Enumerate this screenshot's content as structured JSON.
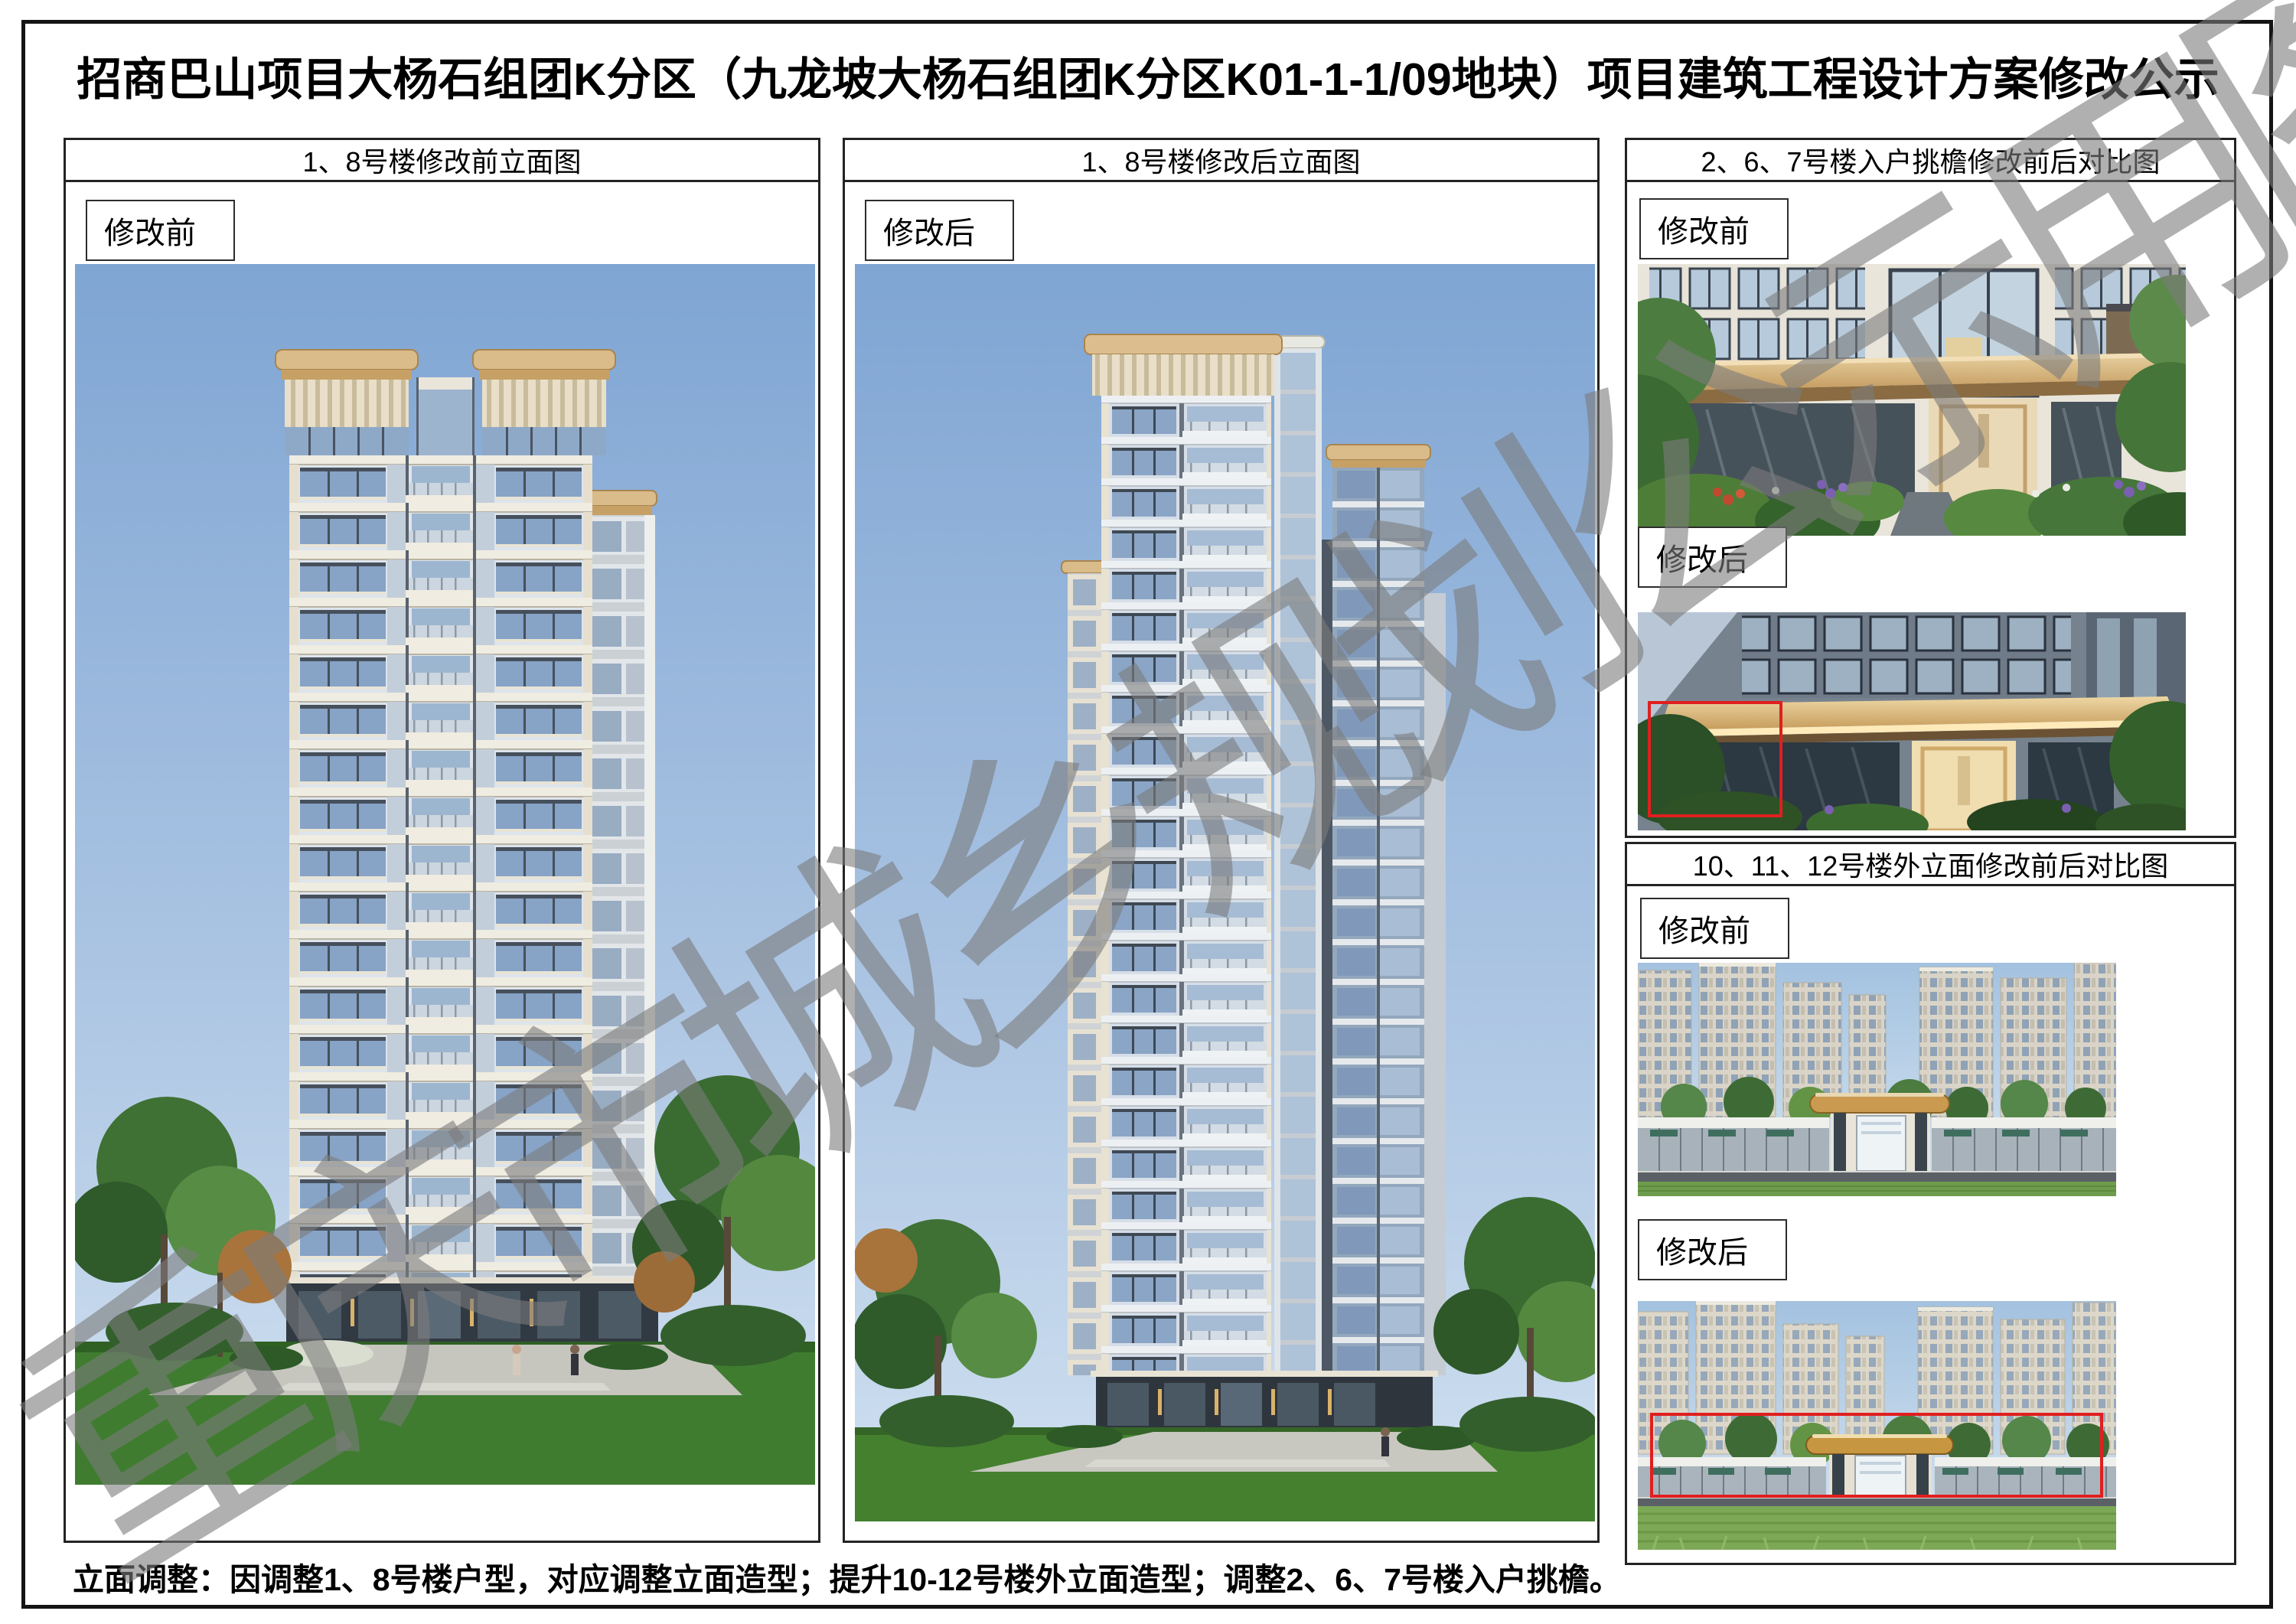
{
  "page": {
    "title": "招商巴山项目大杨石组团K分区（九龙坡大杨石组团K分区K01-1-1/09地块）项目建筑工程设计方案修改公示",
    "note": "立面调整：因调整1、8号楼户型，对应调整立面造型；提升10-12号楼外立面造型；调整2、6、7号楼入户挑檐。",
    "watermark": "重庆市城乡规划公示用图"
  },
  "panels": {
    "left": {
      "header": "1、8号楼修改前立面图",
      "tag": "修改前"
    },
    "middle": {
      "header": "1、8号楼修改后立面图",
      "tag": "修改后"
    },
    "right_top": {
      "header": "2、6、7号楼入户挑檐修改前后对比图",
      "tag_before": "修改前",
      "tag_after": "修改后"
    },
    "right_bottom": {
      "header": "10、11、12号楼外立面修改前后对比图",
      "tag_before": "修改前",
      "tag_after": "修改后"
    }
  },
  "colors": {
    "highlight_box": "#e01f1f",
    "watermark_gray": "#7c7c7c",
    "crown_tan": "#d9bb88"
  }
}
